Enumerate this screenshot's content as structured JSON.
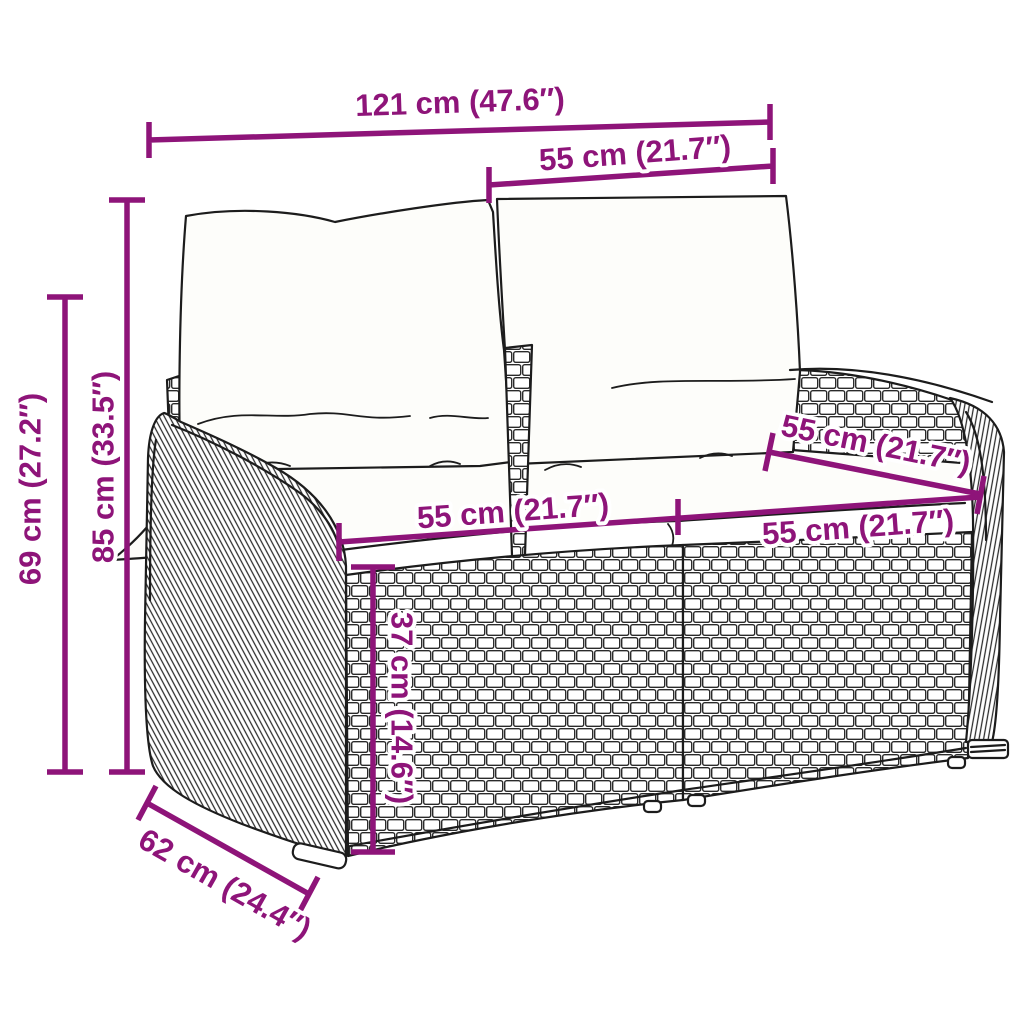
{
  "diagram": {
    "subject": "poly-rattan 2-seater garden bench line drawing with back cushions and seat cushions",
    "colors": {
      "dimension_color": "#8E1479",
      "line_art_color": "#1c1c1c",
      "background": "#ffffff"
    },
    "labels": {
      "overall_width": "121 cm (47.6″)",
      "section_width": "55 cm (21.7″)",
      "total_height": "85 cm (33.5″)",
      "side_height": "69 cm (27.2″)",
      "seat_width_left": "55 cm (21.7″)",
      "seat_width_right": "55 cm (21.7″)",
      "seat_depth": "55 cm (21.7″)",
      "seat_height": "37 cm (14.6″)",
      "base_depth": "62 cm (24.4″)"
    }
  }
}
